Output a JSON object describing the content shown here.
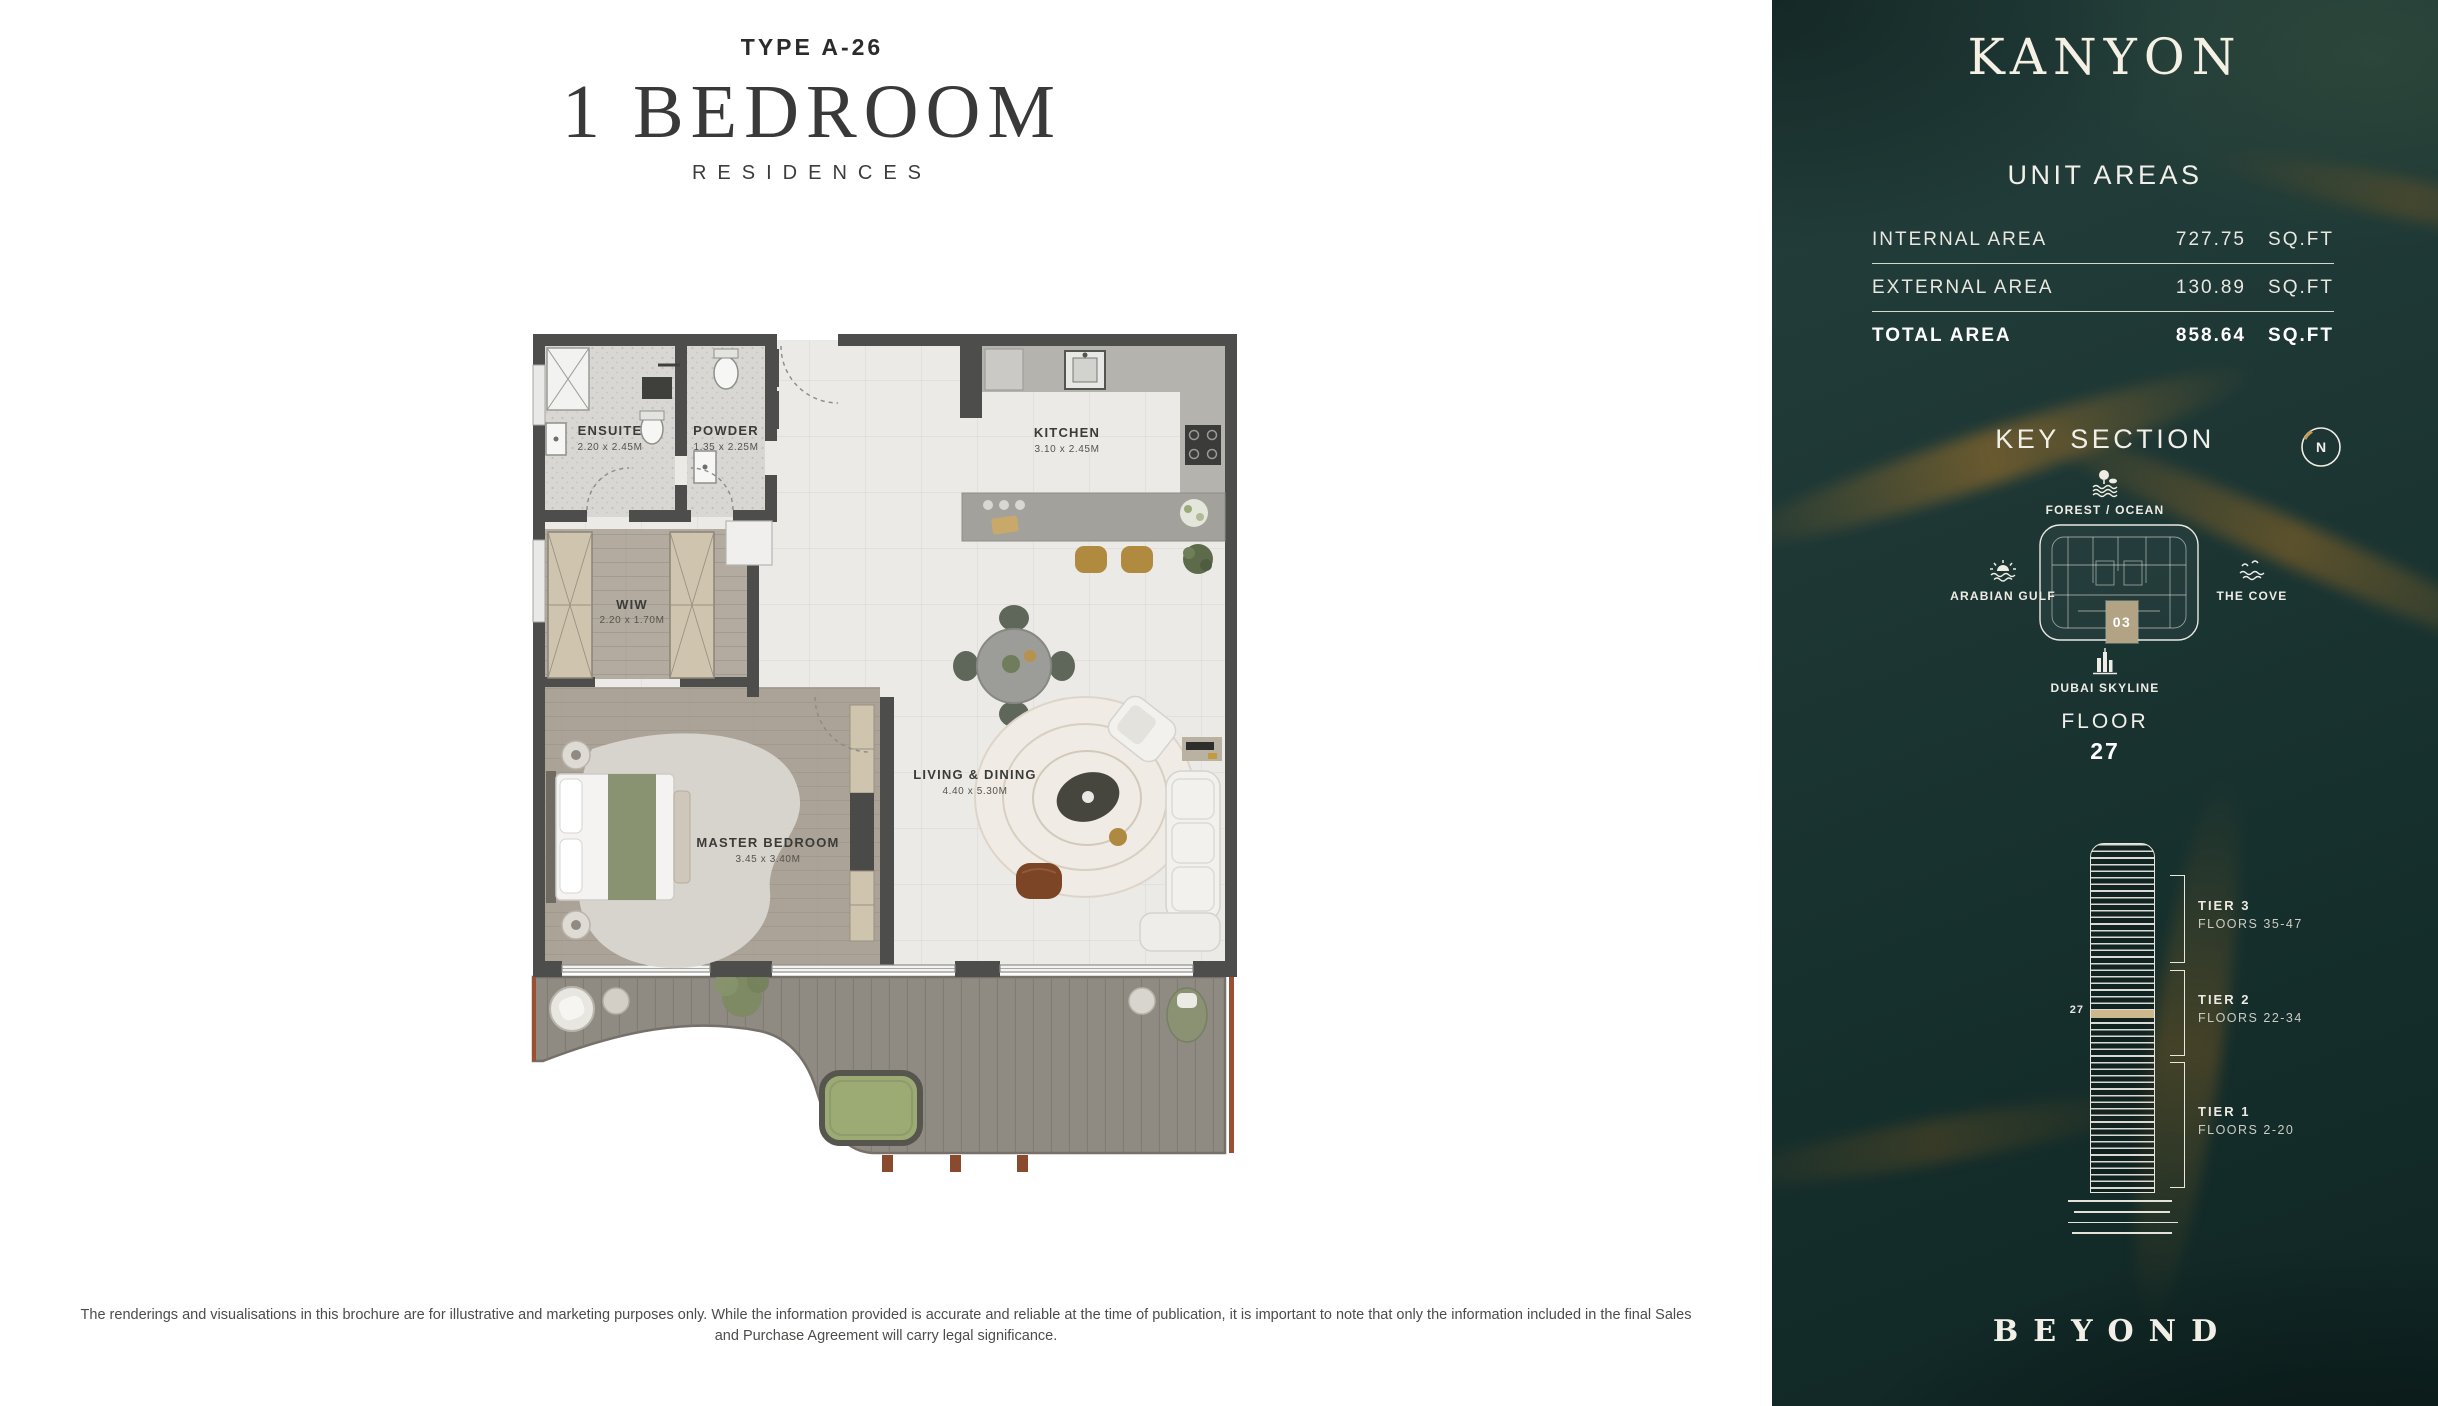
{
  "header": {
    "type_label": "TYPE A-26",
    "title": "1 BEDROOM",
    "subtitle": "RESIDENCES"
  },
  "floorplan": {
    "rooms": [
      {
        "name": "ENSUITE",
        "dims": "2.20 x 2.45M"
      },
      {
        "name": "POWDER",
        "dims": "1.35 x 2.25M"
      },
      {
        "name": "KITCHEN",
        "dims": "3.10 x 2.45M"
      },
      {
        "name": "WIW",
        "dims": "2.20 x 1.70M"
      },
      {
        "name": "MASTER BEDROOM",
        "dims": "3.45 x 3.40M"
      },
      {
        "name": "LIVING & DINING",
        "dims": "4.40 x 5.30M"
      }
    ]
  },
  "disclaimer": {
    "line1": "The renderings and visualisations in this brochure are for illustrative and marketing purposes only. While the information provided is accurate and reliable at the time of publication, it is important to note that only the information included in the final Sales",
    "line2": "and Purchase Agreement will carry legal significance."
  },
  "sidebar": {
    "brand": "KANYON",
    "unit_areas": {
      "title": "UNIT AREAS",
      "rows": [
        {
          "label": "INTERNAL AREA",
          "value": "727.75",
          "unit": "SQ.FT"
        },
        {
          "label": "EXTERNAL AREA",
          "value": "130.89",
          "unit": "SQ.FT"
        },
        {
          "label": "TOTAL AREA",
          "value": "858.64",
          "unit": "SQ.FT"
        }
      ]
    },
    "key_section": {
      "title": "KEY SECTION",
      "compass_label": "N",
      "unit_number": "03",
      "landmarks": {
        "forest_ocean": "FOREST / OCEAN",
        "arabian_gulf": "ARABIAN GULF",
        "the_cove": "THE COVE",
        "dubai_skyline": "DUBAI SKYLINE"
      }
    },
    "floor": {
      "label": "FLOOR",
      "number": "27"
    },
    "tower": {
      "current_floor": "27",
      "tiers": [
        {
          "name": "TIER 3",
          "floors": "FLOORS 35-47"
        },
        {
          "name": "TIER 2",
          "floors": "FLOORS 22-34"
        },
        {
          "name": "TIER 1",
          "floors": "FLOORS 2-20"
        }
      ]
    },
    "footer_brand": "BEYOND"
  },
  "colors": {
    "sidebar_bg": "#1d3634",
    "gold_accent": "#b2a384",
    "wall": "#4d4d4c",
    "deck": "#8f8a82",
    "lawn": "#9cab74",
    "terracotta": "#9c5033"
  }
}
